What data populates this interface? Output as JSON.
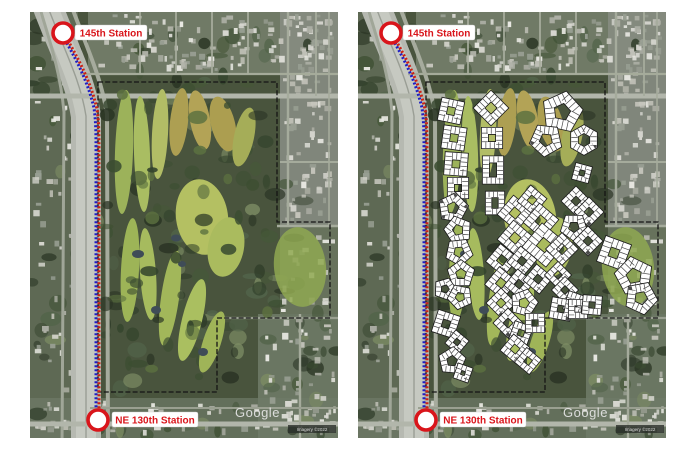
{
  "stations": {
    "top_label": "145th Station",
    "bottom_label": "NE 130th Station"
  },
  "watermark": {
    "google": "Google",
    "imagery_credit": "Imagery ©2022"
  },
  "colors": {
    "station_red": "#d9151b",
    "transit_blue": "#1f1fc4",
    "transit_red": "#cc2214",
    "boundary_black": "#151515",
    "building_white": "#ffffff",
    "freeway_gray": "#b6b9b1"
  },
  "geometry": {
    "boundary_points": "68,70 247,70 247,210 300,210 300,306 187,306 187,380 68,380",
    "transit_blue_d": "M33,24 C44,44 57,66 64,96 C66,110 66,122 66,142 L66,416",
    "transit_red_d": "M36,25 C47,45 60,67 67,97 C69,111 69,123 69,143 L69,418"
  },
  "buildings": [
    {
      "n": 4,
      "x": 93,
      "y": 99,
      "r": 11,
      "a": 12
    },
    {
      "n": 4,
      "x": 96,
      "y": 126,
      "r": 11,
      "a": 8
    },
    {
      "n": 4,
      "x": 98,
      "y": 152,
      "r": 11,
      "a": 4
    },
    {
      "n": 4,
      "x": 100,
      "y": 176,
      "r": 10,
      "a": 0
    },
    {
      "n": 5,
      "x": 95,
      "y": 196,
      "r": 11,
      "a": 10
    },
    {
      "n": 5,
      "x": 100,
      "y": 218,
      "r": 10,
      "a": -15
    },
    {
      "n": 5,
      "x": 101,
      "y": 240,
      "r": 10,
      "a": 30
    },
    {
      "n": 5,
      "x": 103,
      "y": 262,
      "r": 10,
      "a": 0
    },
    {
      "n": 5,
      "x": 87,
      "y": 277,
      "r": 8,
      "a": 20
    },
    {
      "n": 5,
      "x": 102,
      "y": 285,
      "r": 9,
      "a": -25
    },
    {
      "n": 4,
      "x": 88,
      "y": 312,
      "r": 11,
      "a": 18
    },
    {
      "n": 4,
      "x": 99,
      "y": 330,
      "r": 8,
      "a": 40
    },
    {
      "n": 5,
      "x": 94,
      "y": 349,
      "r": 10,
      "a": 5
    },
    {
      "n": 4,
      "x": 105,
      "y": 361,
      "r": 7,
      "a": 20
    },
    {
      "n": 4,
      "x": 133,
      "y": 96,
      "r": 12,
      "a": 45
    },
    {
      "n": 4,
      "x": 134,
      "y": 126,
      "r": 10,
      "a": 0
    },
    {
      "n": 4,
      "x": 135,
      "y": 158,
      "r": 10,
      "a": 0,
      "sy": 1.5
    },
    {
      "n": 4,
      "x": 137,
      "y": 191,
      "r": 9,
      "a": 0,
      "sy": 1.35
    },
    {
      "n": 5,
      "x": 204,
      "y": 100,
      "r": 15,
      "a": 12
    },
    {
      "n": 5,
      "x": 188,
      "y": 128,
      "r": 12,
      "a": -30
    },
    {
      "n": 6,
      "x": 226,
      "y": 128,
      "r": 11,
      "a": 0
    },
    {
      "n": 4,
      "x": 224,
      "y": 161,
      "r": 8,
      "a": 15
    },
    {
      "n": 4,
      "x": 218,
      "y": 189,
      "r": 10,
      "a": 45
    },
    {
      "n": 4,
      "x": 231,
      "y": 200,
      "r": 10,
      "a": 45
    },
    {
      "n": 5,
      "x": 216,
      "y": 215,
      "r": 10,
      "a": 36
    },
    {
      "n": 4,
      "x": 230,
      "y": 229,
      "r": 10,
      "a": 45
    },
    {
      "n": 4,
      "x": 157,
      "y": 201,
      "r": 12,
      "a": 40
    },
    {
      "n": 4,
      "x": 174,
      "y": 188,
      "r": 10,
      "a": 40
    },
    {
      "n": 4,
      "x": 183,
      "y": 209,
      "r": 12,
      "a": 40
    },
    {
      "n": 4,
      "x": 157,
      "y": 226,
      "r": 12,
      "a": 40
    },
    {
      "n": 4,
      "x": 186,
      "y": 233,
      "r": 15,
      "a": 40
    },
    {
      "n": 4,
      "x": 204,
      "y": 237,
      "r": 11,
      "a": 45
    },
    {
      "n": 4,
      "x": 144,
      "y": 248,
      "r": 11,
      "a": 40
    },
    {
      "n": 4,
      "x": 164,
      "y": 249,
      "r": 10,
      "a": 40
    },
    {
      "n": 4,
      "x": 143,
      "y": 271,
      "r": 11,
      "a": 40
    },
    {
      "n": 4,
      "x": 161,
      "y": 272,
      "r": 10,
      "a": 40
    },
    {
      "n": 4,
      "x": 180,
      "y": 267,
      "r": 10,
      "a": 40
    },
    {
      "n": 4,
      "x": 143,
      "y": 291,
      "r": 10,
      "a": 45
    },
    {
      "n": 5,
      "x": 166,
      "y": 291,
      "r": 10,
      "a": 15
    },
    {
      "n": 4,
      "x": 200,
      "y": 263,
      "r": 9,
      "a": 45
    },
    {
      "n": 4,
      "x": 207,
      "y": 278,
      "r": 9,
      "a": 45
    },
    {
      "n": 4,
      "x": 217,
      "y": 291,
      "r": 9,
      "a": 20
    },
    {
      "n": 4,
      "x": 150,
      "y": 311,
      "r": 10,
      "a": 45
    },
    {
      "n": 4,
      "x": 163,
      "y": 321,
      "r": 9,
      "a": 20
    },
    {
      "n": 4,
      "x": 177,
      "y": 311,
      "r": 9,
      "a": 0
    },
    {
      "n": 4,
      "x": 157,
      "y": 337,
      "r": 10,
      "a": 40
    },
    {
      "n": 4,
      "x": 170,
      "y": 349,
      "r": 9,
      "a": 40
    },
    {
      "n": 4,
      "x": 203,
      "y": 297,
      "r": 10,
      "a": 10
    },
    {
      "n": 4,
      "x": 220,
      "y": 297,
      "r": 9,
      "a": 0
    },
    {
      "n": 4,
      "x": 234,
      "y": 293,
      "r": 9,
      "a": 5
    },
    {
      "n": 4,
      "x": 256,
      "y": 241,
      "r": 13,
      "a": 20
    },
    {
      "n": 5,
      "x": 276,
      "y": 264,
      "r": 14,
      "a": -10
    },
    {
      "n": 5,
      "x": 283,
      "y": 286,
      "r": 12,
      "a": 25
    }
  ]
}
